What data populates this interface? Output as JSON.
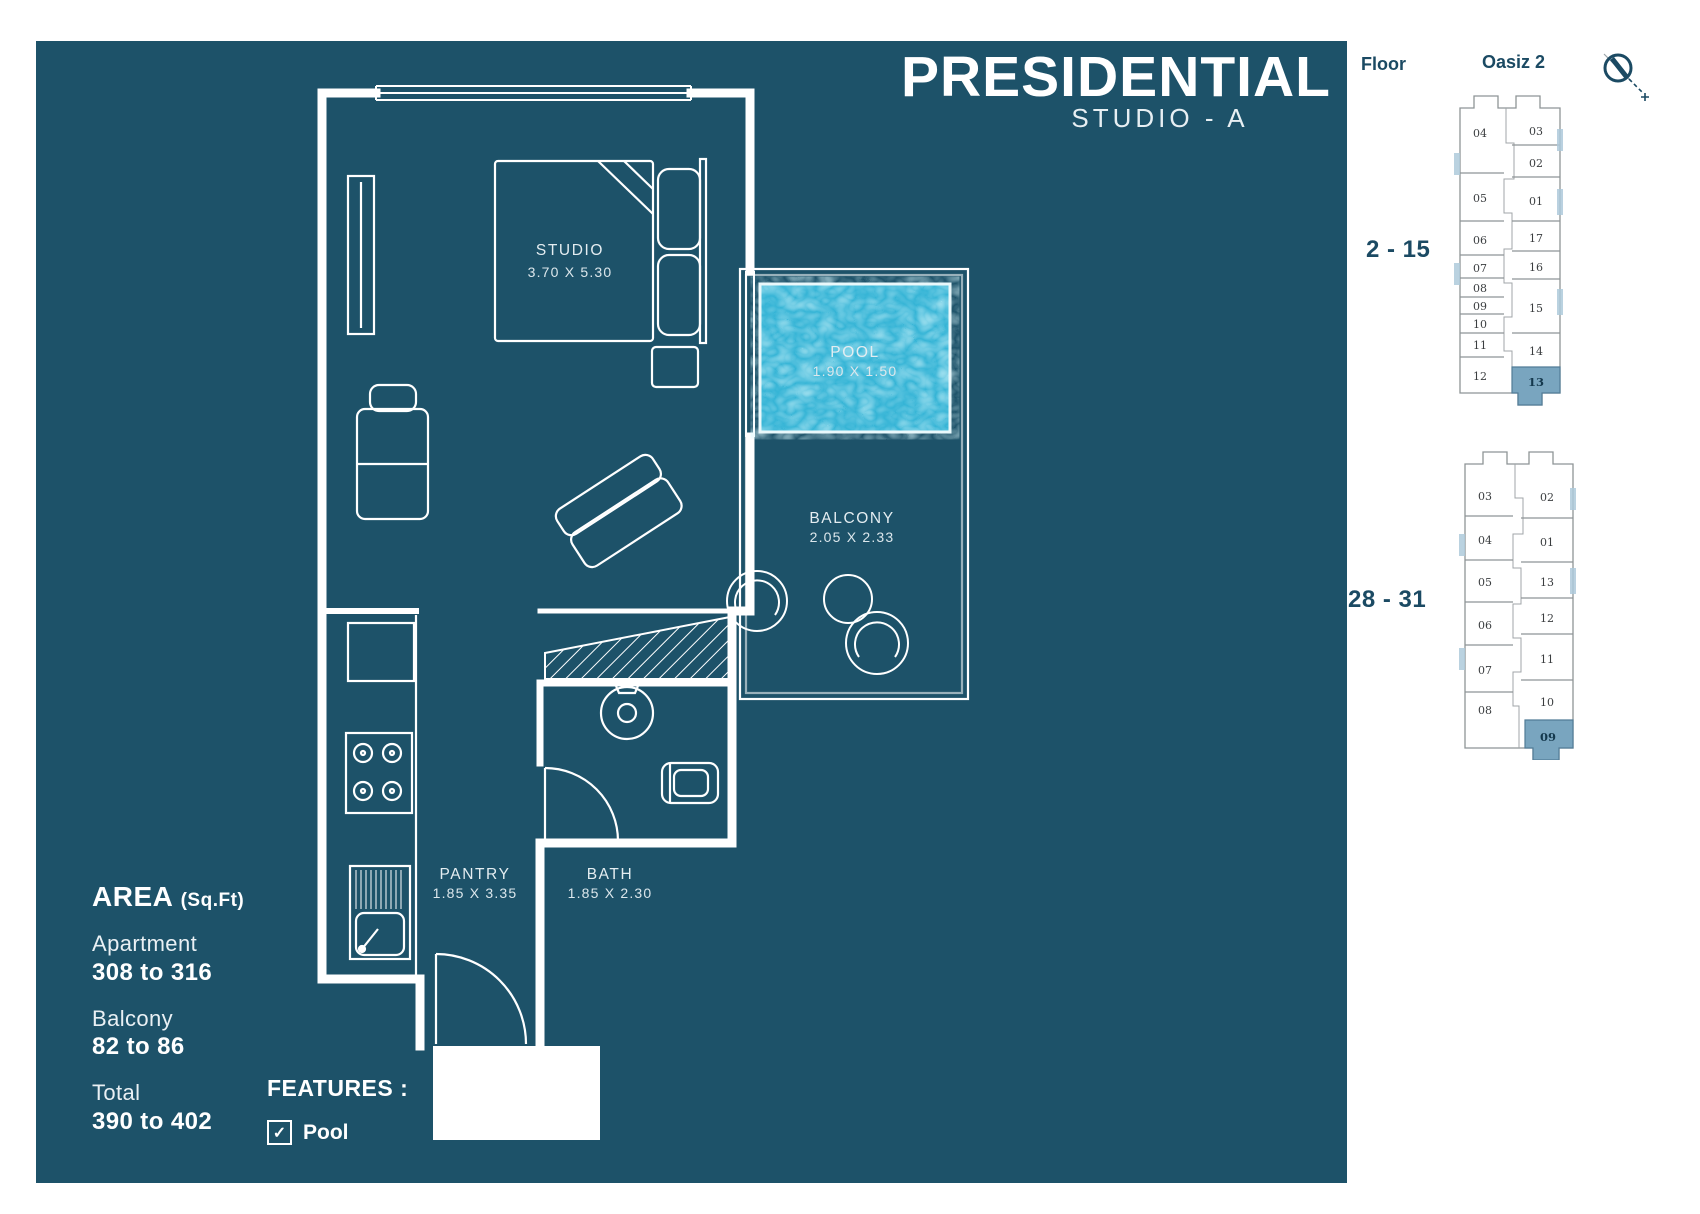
{
  "title": {
    "main": "PRESIDENTIAL",
    "sub": "STUDIO - A"
  },
  "plan": {
    "rooms": {
      "studio": {
        "name": "STUDIO",
        "dims": "3.70 X 5.30"
      },
      "pool": {
        "name": "POOL",
        "dims": "1.90 X 1.50"
      },
      "balcony": {
        "name": "BALCONY",
        "dims": "2.05 X 2.33"
      },
      "pantry": {
        "name": "PANTRY",
        "dims": "1.85 X 3.35"
      },
      "bath": {
        "name": "BATH",
        "dims": "1.85 X 2.30"
      }
    }
  },
  "area": {
    "heading": "AREA",
    "unit": "(Sq.Ft)",
    "rows": [
      {
        "label": "Apartment",
        "value": "308 to 316"
      },
      {
        "label": "Balcony",
        "value": "82 to 86"
      },
      {
        "label": "Total",
        "value": "390 to 402"
      }
    ]
  },
  "features": {
    "heading": "FEATURES :",
    "check_glyph": "✓",
    "items": [
      {
        "label": "Pool",
        "checked": true
      }
    ]
  },
  "floor_key": {
    "floor_heading": "Floor",
    "project": "Oasiz 2",
    "plans": [
      {
        "floors": "2 - 15",
        "left_units": [
          "04",
          "05",
          "06",
          "07",
          "08",
          "09",
          "10",
          "11",
          "12"
        ],
        "right_units": [
          "03",
          "02",
          "01",
          "17",
          "16",
          "15",
          "14",
          "13"
        ],
        "highlighted_unit": "13"
      },
      {
        "floors": "28 - 31",
        "left_units": [
          "03",
          "04",
          "05",
          "06",
          "07",
          "08"
        ],
        "right_units": [
          "02",
          "01",
          "13",
          "12",
          "11",
          "10",
          "09"
        ],
        "highlighted_unit": "09"
      }
    ]
  },
  "colors": {
    "panel_bg": "#1d5269",
    "plan_lines": "#ffffff",
    "pool_water": "#35b4d6",
    "unit_highlight": "#79a5bf",
    "sidebar_text": "#1b4a63"
  }
}
